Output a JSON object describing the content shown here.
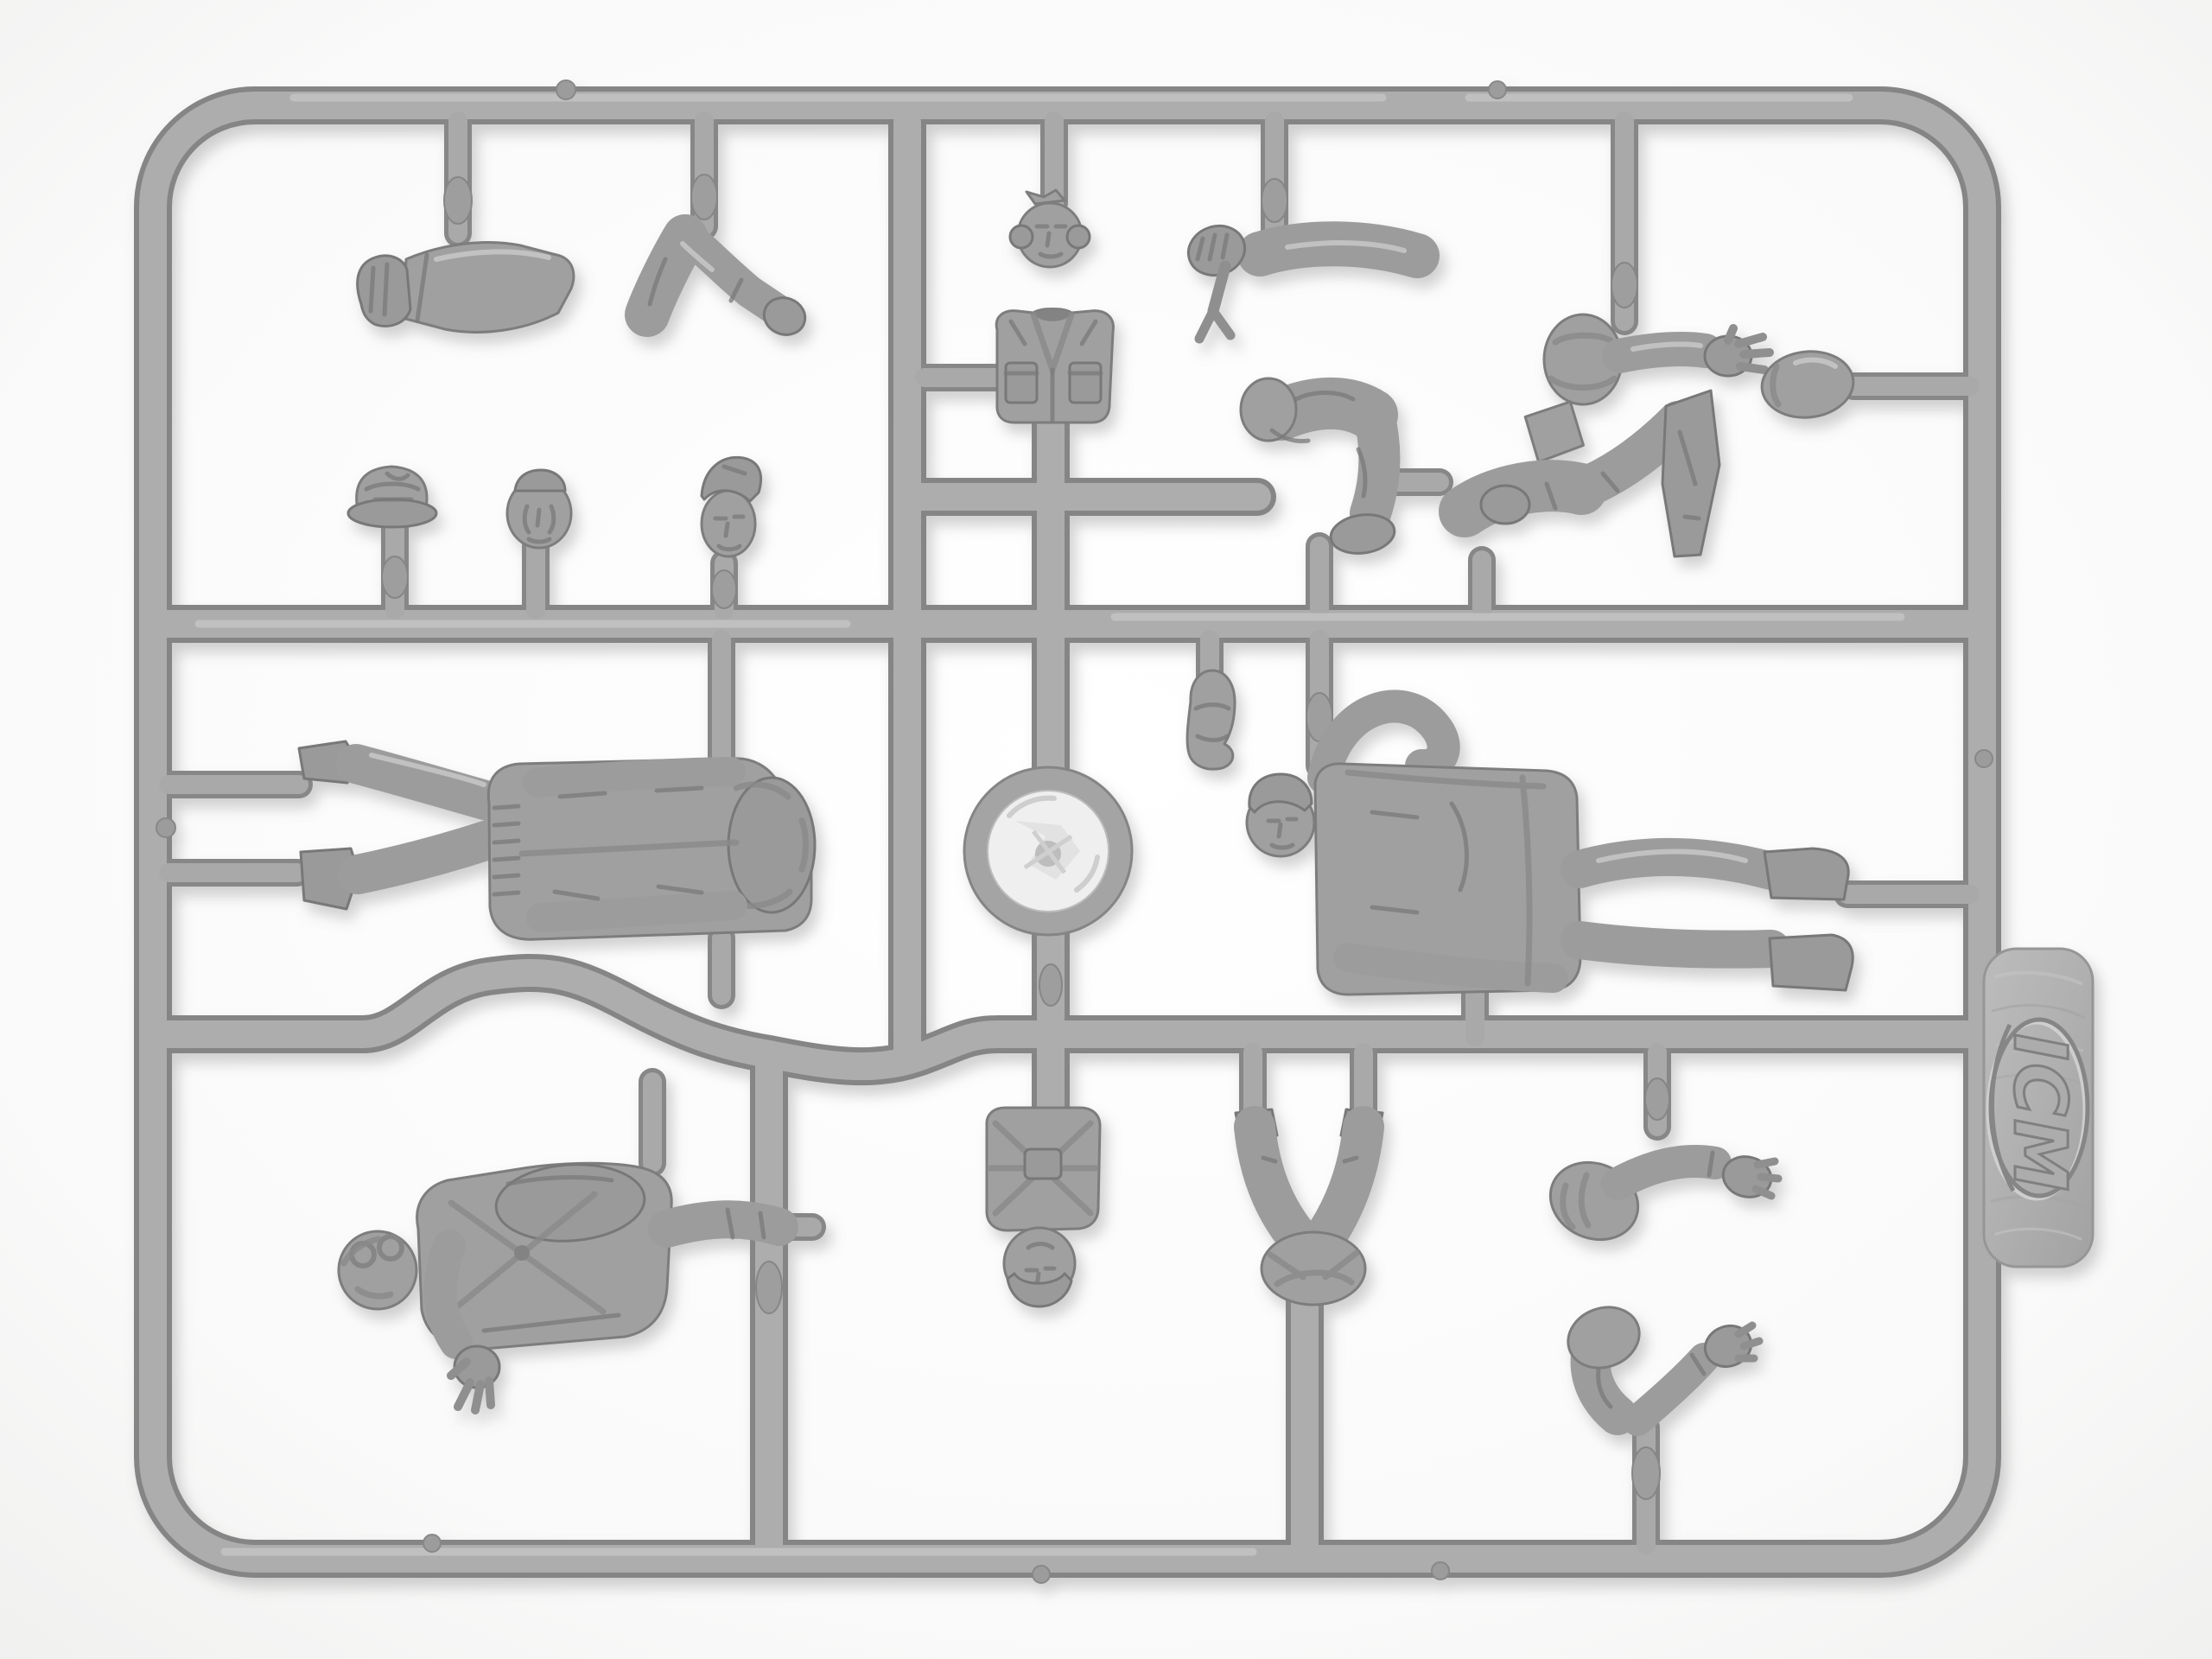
{
  "scene": {
    "subject": "Gray plastic model-kit sprue with military figure parts on a white background",
    "background_color": "#fbfbfa",
    "plastic_color": "#a6a6a6",
    "plastic_shadow_color": "#858585",
    "plastic_highlight_color": "#c8c8c8",
    "foil_disc_color": "#efefef"
  },
  "logo": {
    "text": "ICM"
  },
  "parts": [
    {
      "name": "arm-straight-with-fist"
    },
    {
      "name": "arm-bent-elbow"
    },
    {
      "name": "head-pilot-headset"
    },
    {
      "name": "arm-holding-wrench"
    },
    {
      "name": "forearm-open-hand-with-boot-sole"
    },
    {
      "name": "seated-legs-left"
    },
    {
      "name": "seated-legs-right"
    },
    {
      "name": "head-in-flight-helmet"
    },
    {
      "name": "head-crusher-cap"
    },
    {
      "name": "head-winter-cap"
    },
    {
      "name": "head-garrison-cap"
    },
    {
      "name": "jacket-torso-vest"
    },
    {
      "name": "clear-disc-part"
    },
    {
      "name": "field-cap-part"
    },
    {
      "name": "figure-standing-airman-headless"
    },
    {
      "name": "figure-standing-crewman"
    },
    {
      "name": "figure-pilot-with-goggles"
    },
    {
      "name": "torso-with-parachute-harness"
    },
    {
      "name": "kneeling-legs"
    },
    {
      "name": "arm-bent-hand-open"
    },
    {
      "name": "arm-bent-hand-raised"
    },
    {
      "name": "icm-logo-tab"
    }
  ]
}
